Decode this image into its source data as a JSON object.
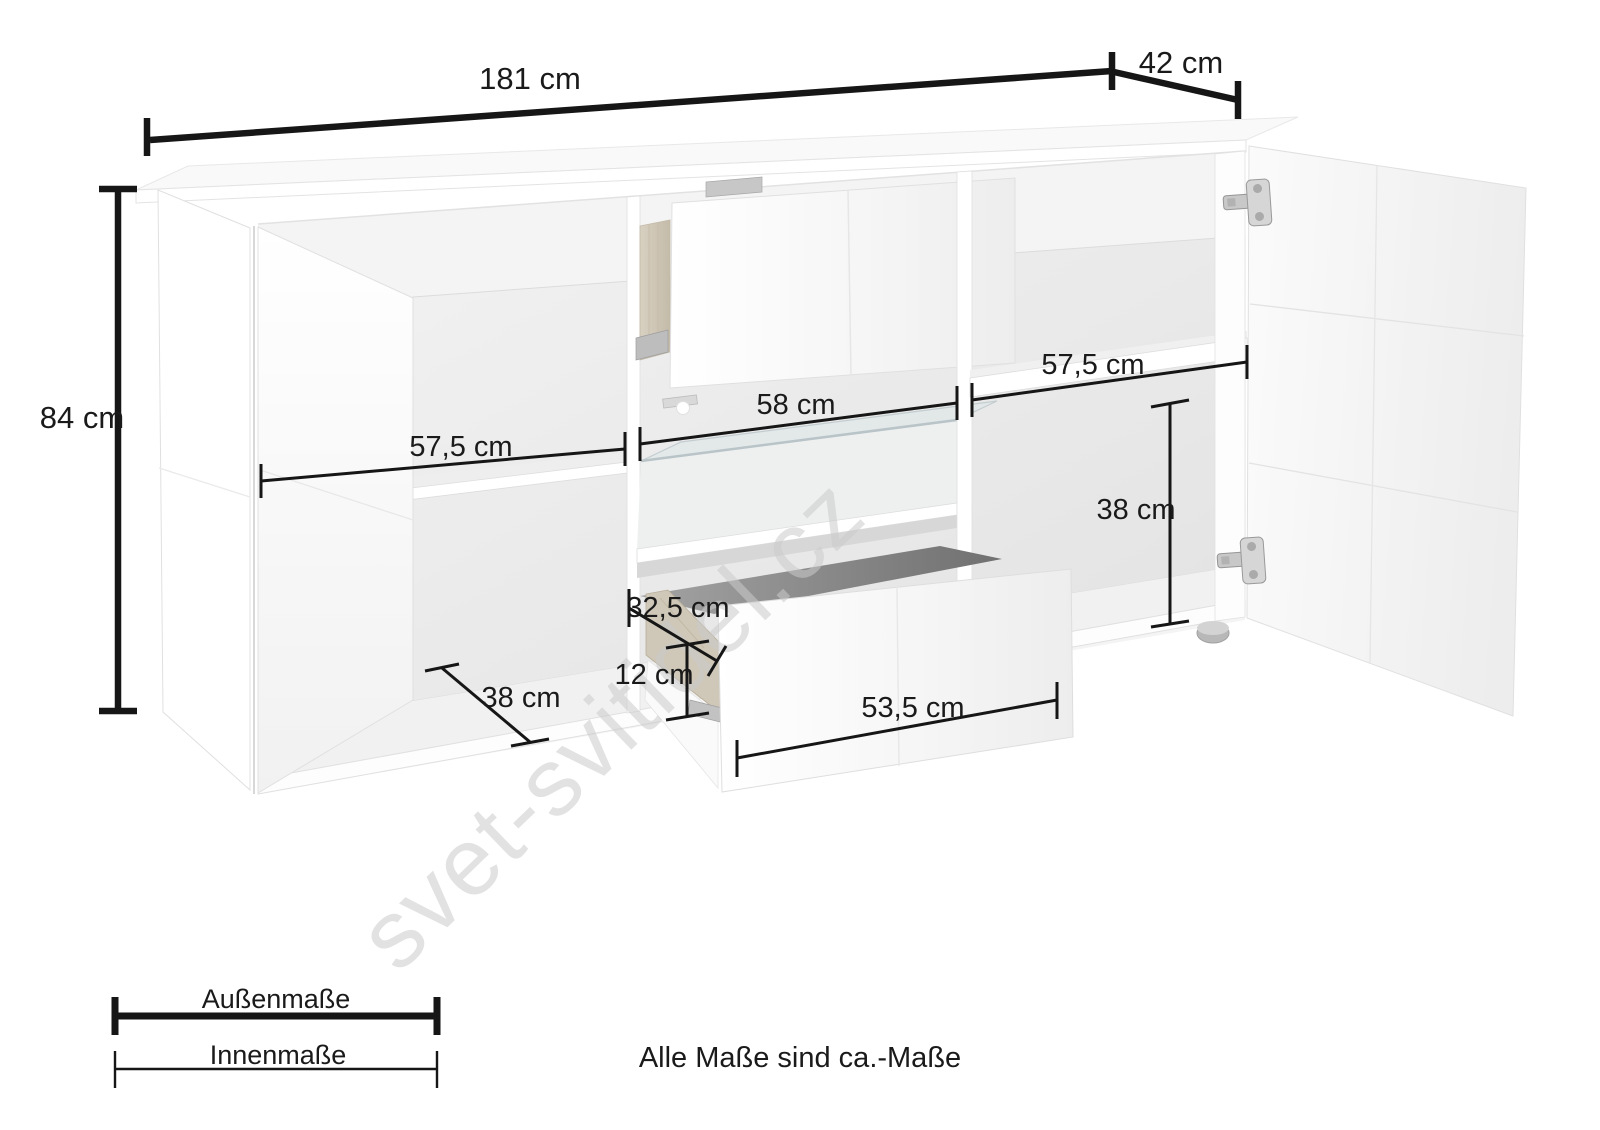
{
  "diagram": {
    "type": "furniture-dimension-diagram",
    "subject": "sideboard with open doors and pulled-out drawers",
    "units": "cm",
    "labels": {
      "w_total": "181 cm",
      "d_total": "42 cm",
      "h_total": "84 cm",
      "w_left": "57,5 cm",
      "w_mid": "58 cm",
      "w_right": "57,5 cm",
      "h_right": "38 cm",
      "d_drawer": "32,5 cm",
      "h_drawer": "12 cm",
      "w_drawer": "53,5 cm",
      "d_left": "38 cm"
    },
    "legend": {
      "outer_label": "Außenmaße",
      "inner_label": "Innenmaße"
    },
    "note": "Alle Maße sind ca.-Maße",
    "watermark": "svet-svitidel.cz",
    "colors": {
      "dimension_line": "#161616",
      "panel": "#ffffff",
      "interior_back": "#e9e9e9",
      "wood": "#d0c8b8",
      "metal": "#c4c4c4",
      "drawer_cavity": "#8d8d8d",
      "watermark": "#cbcbcb"
    }
  }
}
